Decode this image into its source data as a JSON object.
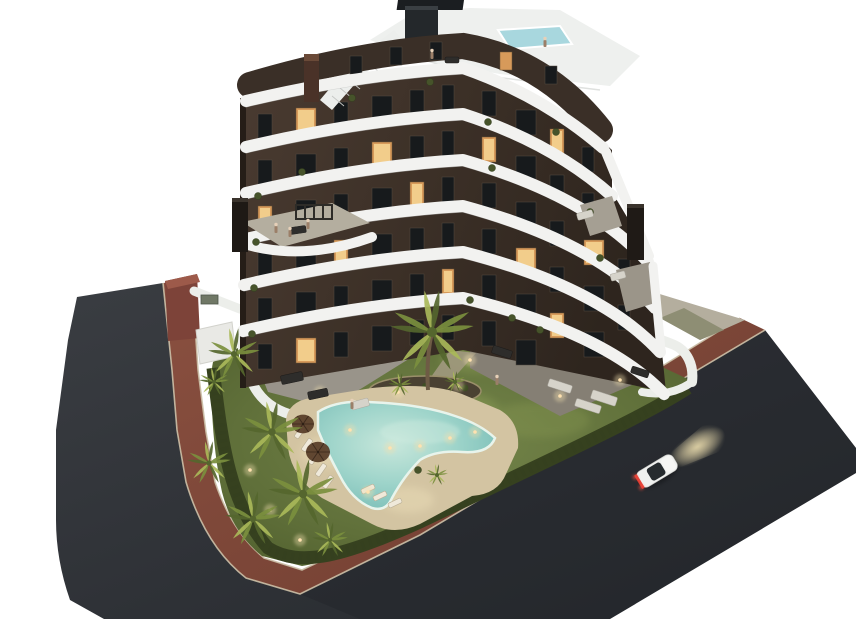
{
  "scene": {
    "type": "3d-architectural-render",
    "description": "aerial dusk render of a modern stepped apartment building with communal garden, boomerang swimming pool, palm trees, perimeter roads and a white car",
    "background": "#ffffff"
  },
  "palette": {
    "bg": "#ffffff",
    "road": "#33363b",
    "roadDark": "#26292d",
    "sidewalk": "#8a5040",
    "sidewalkDark": "#6f3d30",
    "curb": "#cbbfa6",
    "lawn": "#74854a",
    "lawnDark": "#55652f",
    "hedge": "#36411f",
    "facade": "#46382f",
    "facadeDark": "#2e251e",
    "band": "#f2f2f0",
    "bandShadow": "#b9bcba",
    "window": "#171a1c",
    "windowLit": "#d79a5a",
    "windowGlow": "#f7d694",
    "roofDeck": "#eef0ee",
    "roofPool": "#a8d7de",
    "terraceFloor": "#9b958c",
    "wallWhite": "#eceeea",
    "deck": "#d3c4a2",
    "deckLit": "#f0e2bc",
    "poolEdge": "#d2ebe0",
    "poolMid": "#8fd0c8",
    "poolDeep": "#6cb5b0",
    "soil": "#4a4132",
    "palmDark": "#55662e",
    "palmMid": "#7b8f3e",
    "palmLight": "#a9b859",
    "trunk": "#6e5b45",
    "carBody": "#eff0ee",
    "carGlass": "#262b2e",
    "tailLight": "#e0392e",
    "glow": "#f0dfae",
    "neighbor": "#7d4339",
    "person": "#e6d0b8"
  },
  "building": {
    "floors_visible": 7,
    "bands": [
      [
        246,
        101,
        603,
        148,
        68
      ],
      [
        246,
        147,
        612,
        196,
        114
      ],
      [
        246,
        193,
        648,
        262,
        160
      ],
      [
        246,
        239,
        655,
        308,
        206
      ],
      [
        244,
        285,
        660,
        352,
        252
      ],
      [
        243,
        331,
        664,
        394,
        298
      ]
    ],
    "windows": [
      {
        "a": 68,
        "left": [
          [
            258,
            114,
            14,
            0
          ],
          [
            296,
            108,
            20,
            1
          ],
          [
            334,
            102,
            14,
            0
          ],
          [
            372,
            96,
            20,
            0
          ],
          [
            410,
            90,
            14,
            0
          ],
          [
            442,
            85,
            12,
            0
          ]
        ],
        "right": [
          [
            482,
            91,
            14,
            0
          ],
          [
            516,
            110,
            20,
            0
          ],
          [
            550,
            129,
            14,
            1
          ],
          [
            582,
            147,
            12,
            0
          ]
        ]
      },
      {
        "a": 114,
        "left": [
          [
            258,
            160,
            14,
            0
          ],
          [
            296,
            154,
            20,
            0
          ],
          [
            334,
            148,
            14,
            0
          ],
          [
            372,
            142,
            20,
            1
          ],
          [
            410,
            136,
            14,
            0
          ],
          [
            442,
            131,
            12,
            0
          ]
        ],
        "right": [
          [
            482,
            137,
            14,
            1
          ],
          [
            516,
            156,
            20,
            0
          ],
          [
            550,
            175,
            14,
            0
          ],
          [
            582,
            193,
            12,
            0
          ]
        ]
      },
      {
        "a": 160,
        "left": [
          [
            258,
            206,
            14,
            1
          ],
          [
            296,
            200,
            20,
            0
          ],
          [
            334,
            194,
            14,
            0
          ],
          [
            372,
            188,
            20,
            0
          ],
          [
            410,
            182,
            14,
            1
          ],
          [
            442,
            177,
            12,
            0
          ]
        ],
        "right": [
          [
            482,
            183,
            14,
            0
          ],
          [
            516,
            202,
            20,
            0
          ],
          [
            550,
            221,
            14,
            0
          ],
          [
            584,
            240,
            20,
            1
          ],
          [
            618,
            259,
            12,
            0
          ]
        ]
      },
      {
        "a": 206,
        "left": [
          [
            258,
            252,
            14,
            0
          ],
          [
            296,
            246,
            20,
            0
          ],
          [
            334,
            240,
            14,
            1
          ],
          [
            372,
            234,
            20,
            0
          ],
          [
            410,
            228,
            14,
            0
          ],
          [
            442,
            223,
            12,
            0
          ]
        ],
        "right": [
          [
            482,
            229,
            14,
            0
          ],
          [
            516,
            248,
            20,
            1
          ],
          [
            550,
            267,
            14,
            0
          ],
          [
            584,
            286,
            20,
            0
          ],
          [
            618,
            305,
            12,
            0
          ]
        ]
      },
      {
        "a": 252,
        "left": [
          [
            258,
            298,
            14,
            0
          ],
          [
            296,
            292,
            20,
            0
          ],
          [
            334,
            286,
            14,
            0
          ],
          [
            372,
            280,
            20,
            0
          ],
          [
            410,
            274,
            14,
            0
          ],
          [
            442,
            269,
            12,
            1
          ]
        ],
        "right": [
          [
            482,
            275,
            14,
            0
          ],
          [
            516,
            294,
            20,
            0
          ],
          [
            550,
            313,
            14,
            1
          ],
          [
            584,
            332,
            20,
            0
          ]
        ]
      },
      {
        "a": 298,
        "left": [
          [
            258,
            344,
            14,
            0
          ],
          [
            296,
            338,
            20,
            1
          ],
          [
            334,
            332,
            14,
            0
          ],
          [
            372,
            326,
            20,
            0
          ],
          [
            410,
            320,
            14,
            0
          ],
          [
            442,
            315,
            12,
            0
          ]
        ],
        "right": [
          [
            482,
            321,
            14,
            0
          ],
          [
            516,
            340,
            20,
            0
          ]
        ]
      }
    ]
  },
  "garden": {
    "palms": [
      [
        234,
        354,
        26,
        0
      ],
      [
        272,
        432,
        31,
        0
      ],
      [
        303,
        494,
        35,
        0
      ],
      [
        253,
        519,
        28,
        0
      ],
      [
        209,
        463,
        22,
        0
      ],
      [
        330,
        540,
        18,
        0
      ],
      [
        214,
        382,
        15,
        0
      ],
      [
        400,
        385,
        12,
        0
      ],
      [
        455,
        382,
        11,
        0
      ],
      [
        437,
        475,
        11,
        0
      ],
      [
        432,
        332,
        42,
        58
      ]
    ],
    "loungers": [
      [
        300,
        432,
        -55
      ],
      [
        307,
        445,
        -55
      ],
      [
        314,
        458,
        -55
      ],
      [
        321,
        470,
        -55
      ],
      [
        328,
        482,
        -55
      ],
      [
        380,
        496,
        -25
      ],
      [
        395,
        503,
        -25
      ],
      [
        368,
        489,
        -25
      ]
    ],
    "parasols": [
      [
        303,
        424,
        11
      ],
      [
        318,
        452,
        12
      ]
    ],
    "lights": [
      [
        398,
        392
      ],
      [
        458,
        386
      ],
      [
        350,
        430
      ],
      [
        368,
        492
      ],
      [
        390,
        448
      ],
      [
        420,
        446
      ],
      [
        450,
        438
      ],
      [
        475,
        432
      ],
      [
        250,
        470
      ],
      [
        270,
        510
      ],
      [
        300,
        540
      ],
      [
        320,
        392
      ],
      [
        560,
        396
      ],
      [
        620,
        380
      ],
      [
        470,
        360
      ]
    ],
    "plants": [
      [
        258,
        196
      ],
      [
        256,
        242
      ],
      [
        254,
        288
      ],
      [
        252,
        334
      ],
      [
        302,
        172
      ],
      [
        488,
        122
      ],
      [
        492,
        168
      ],
      [
        590,
        212
      ],
      [
        600,
        258
      ],
      [
        556,
        132
      ],
      [
        352,
        98
      ],
      [
        430,
        82
      ],
      [
        470,
        300
      ],
      [
        512,
        318
      ],
      [
        540,
        330
      ],
      [
        418,
        470
      ]
    ],
    "furniture": [
      [
        298,
        230,
        16,
        7,
        -8,
        "dark"
      ],
      [
        452,
        60,
        14,
        6,
        0,
        "dark"
      ],
      [
        585,
        215,
        16,
        7,
        -15,
        "light"
      ],
      [
        618,
        276,
        15,
        7,
        -15,
        "light"
      ],
      [
        292,
        378,
        22,
        9,
        -12,
        "dark"
      ],
      [
        318,
        394,
        20,
        8,
        -12,
        "dark"
      ],
      [
        360,
        404,
        18,
        8,
        -15,
        "light"
      ],
      [
        502,
        352,
        20,
        8,
        18,
        "dark"
      ],
      [
        560,
        386,
        24,
        8,
        18,
        "light"
      ],
      [
        604,
        398,
        26,
        9,
        18,
        "light"
      ],
      [
        640,
        372,
        18,
        7,
        18,
        "dark"
      ],
      [
        588,
        406,
        26,
        8,
        18,
        "light"
      ]
    ],
    "people": [
      [
        352,
        402
      ],
      [
        497,
        378
      ],
      [
        276,
        226
      ],
      [
        290,
        230
      ],
      [
        308,
        222
      ],
      [
        432,
        52
      ],
      [
        545,
        40
      ]
    ]
  },
  "car": {
    "x": 657,
    "y": 471,
    "angle": -31,
    "body": "white",
    "state": "driving with headlights on"
  }
}
